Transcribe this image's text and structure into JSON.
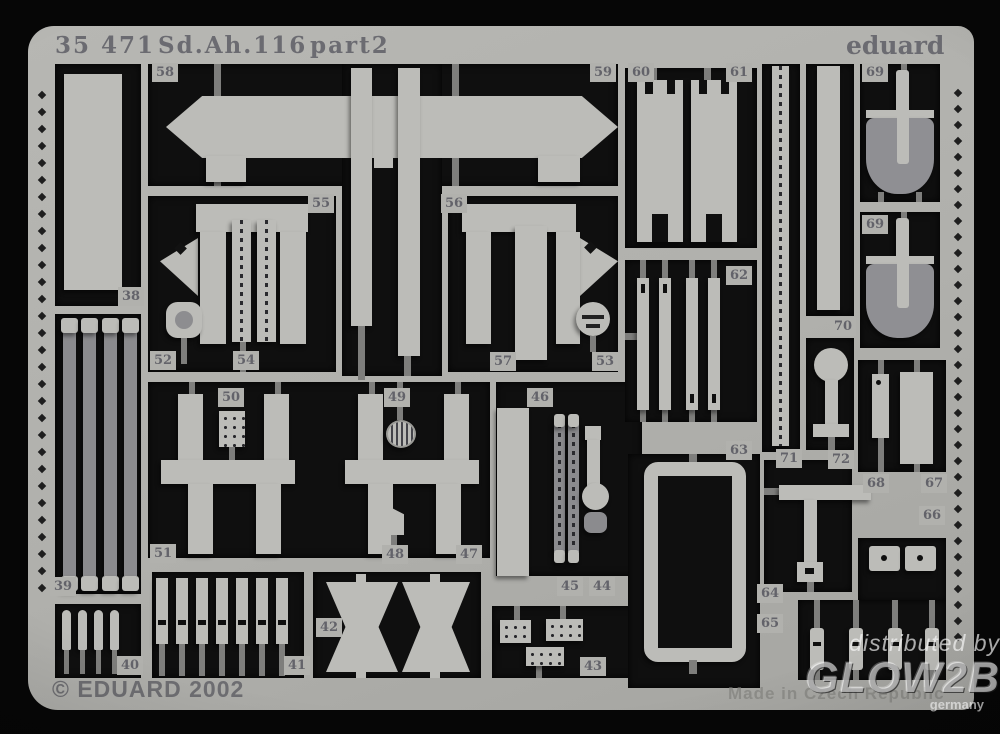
{
  "header": {
    "catalog": "35 471",
    "name": "Sd.Ah.116",
    "part": "part2",
    "brand": "eduard"
  },
  "footer": {
    "copyright": "© EDUARD 2002",
    "made_in": "Made in Czech Republic"
  },
  "watermark": {
    "line1": "distributed by",
    "line2": "GLOW2B",
    "line3": "germany"
  },
  "colors": {
    "background": "#060606",
    "fret": "#b1b1ad",
    "part_light": "#bcbcb8",
    "part_dark": "#8b8b8e",
    "connector": "#7e7e7c",
    "etched_text": "#6b6b71",
    "watermark_white": "rgba(248,248,248,0.6)"
  },
  "parts": [
    {
      "label": "58",
      "x": 152,
      "y": 63
    },
    {
      "label": "59",
      "x": 590,
      "y": 63
    },
    {
      "label": "60",
      "x": 628,
      "y": 63
    },
    {
      "label": "61",
      "x": 726,
      "y": 63
    },
    {
      "label": "69",
      "x": 862,
      "y": 63
    },
    {
      "label": "69",
      "x": 862,
      "y": 215
    },
    {
      "label": "38",
      "x": 118,
      "y": 287
    },
    {
      "label": "62",
      "x": 726,
      "y": 266
    },
    {
      "label": "70",
      "x": 830,
      "y": 317
    },
    {
      "label": "55",
      "x": 308,
      "y": 194
    },
    {
      "label": "56",
      "x": 441,
      "y": 194
    },
    {
      "label": "52",
      "x": 150,
      "y": 351
    },
    {
      "label": "54",
      "x": 233,
      "y": 351
    },
    {
      "label": "57",
      "x": 490,
      "y": 352
    },
    {
      "label": "53",
      "x": 592,
      "y": 352
    },
    {
      "label": "50",
      "x": 218,
      "y": 388
    },
    {
      "label": "49",
      "x": 384,
      "y": 388
    },
    {
      "label": "46",
      "x": 527,
      "y": 388
    },
    {
      "label": "63",
      "x": 726,
      "y": 441
    },
    {
      "label": "71",
      "x": 776,
      "y": 449
    },
    {
      "label": "72",
      "x": 828,
      "y": 450
    },
    {
      "label": "68",
      "x": 863,
      "y": 474
    },
    {
      "label": "67",
      "x": 921,
      "y": 474
    },
    {
      "label": "66",
      "x": 919,
      "y": 506
    },
    {
      "label": "39",
      "x": 50,
      "y": 577
    },
    {
      "label": "51",
      "x": 150,
      "y": 544
    },
    {
      "label": "48",
      "x": 382,
      "y": 545
    },
    {
      "label": "47",
      "x": 456,
      "y": 545
    },
    {
      "label": "45",
      "x": 557,
      "y": 577
    },
    {
      "label": "44",
      "x": 589,
      "y": 577
    },
    {
      "label": "64",
      "x": 757,
      "y": 584
    },
    {
      "label": "65",
      "x": 757,
      "y": 614
    },
    {
      "label": "40",
      "x": 117,
      "y": 656
    },
    {
      "label": "41",
      "x": 284,
      "y": 656
    },
    {
      "label": "42",
      "x": 316,
      "y": 618
    },
    {
      "label": "43",
      "x": 580,
      "y": 657
    }
  ]
}
